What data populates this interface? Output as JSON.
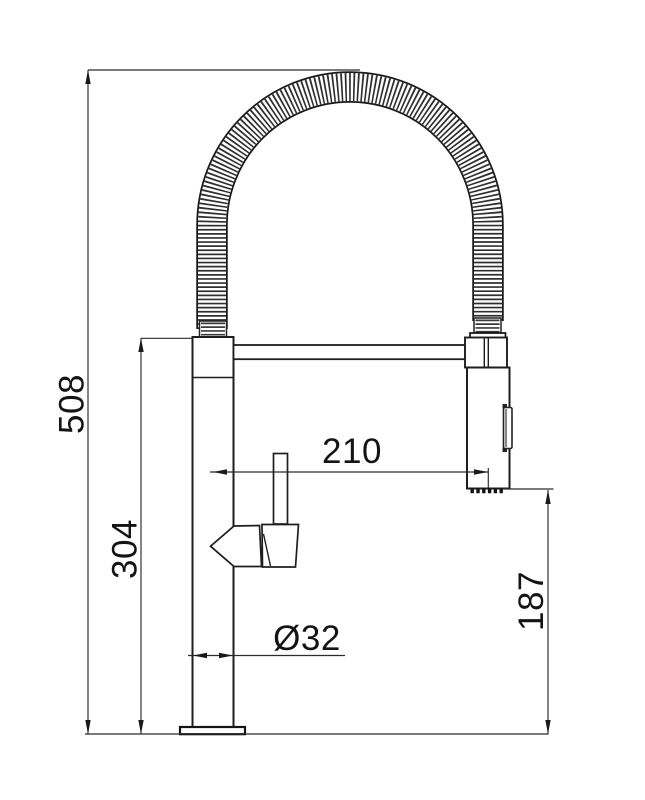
{
  "drawing": {
    "background_color": "#ffffff",
    "line_color": "#1e1e1e",
    "dimension_line_color": "#2b2b2b",
    "dimensions": {
      "total_height": "508",
      "column_height": "304",
      "spout_reach": "210",
      "base_diameter": "Ø32",
      "outlet_height": "187"
    }
  }
}
